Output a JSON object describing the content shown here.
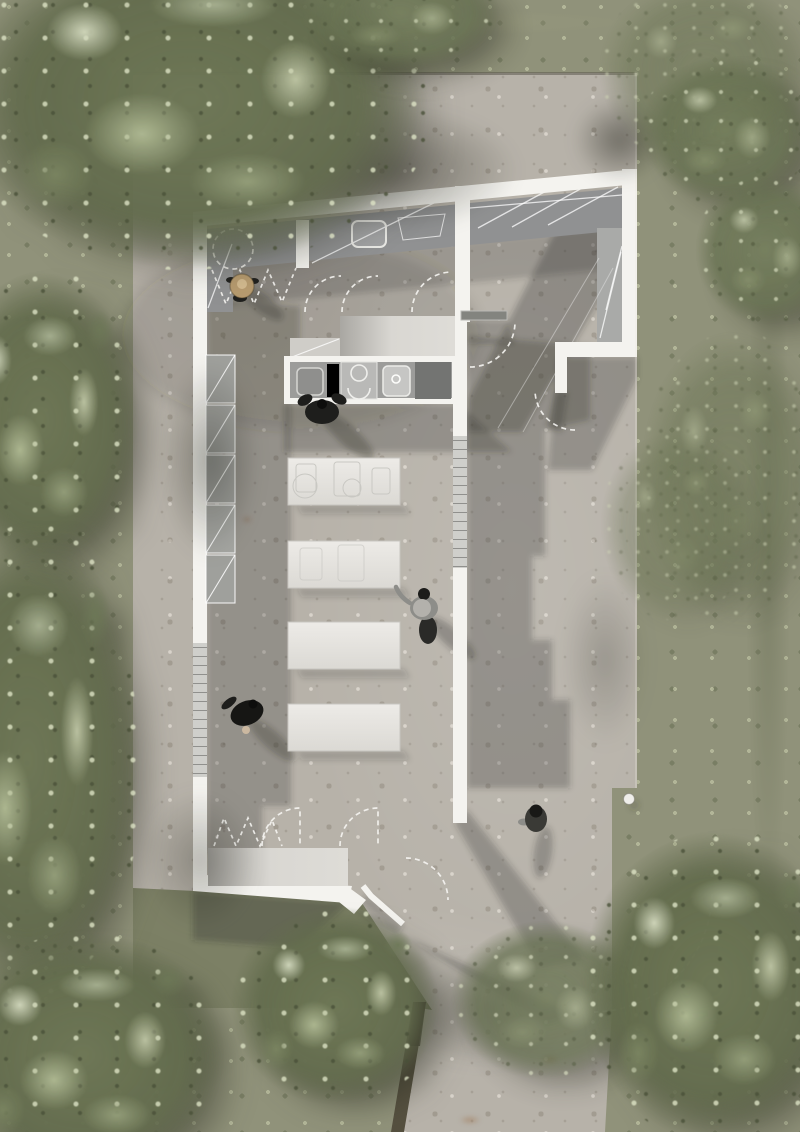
{
  "scene": {
    "type": "architectural-site-plan",
    "view": "top-down rendered plan",
    "subject": "L-shaped pavilion with outdoor kitchen, dining tables and surrounding trees",
    "people_count": 5,
    "dining_table_count": 4,
    "wall_panel_count": 5,
    "people": [
      {
        "id": "seated-person-straw-hat",
        "location": "upper-left terrace"
      },
      {
        "id": "person-at-kitchen-counter",
        "location": "below kitchen counter"
      },
      {
        "id": "walking-person-gray-shirt-hat",
        "location": "center courtyard"
      },
      {
        "id": "person-dark-clothes",
        "location": "lower-left courtyard"
      },
      {
        "id": "walking-person",
        "location": "lower-right terrace"
      }
    ],
    "features": [
      "sloped top wall with canopy band and skylight",
      "dashed door-swing arcs",
      "folding-door zigzag markings",
      "glazed wall sections",
      "kitchen counter with sinks and cooktop",
      "bench",
      "column dot",
      "path with timber kerb"
    ]
  },
  "colors": {
    "grassBase": "#90927a",
    "grassDark": "#7c8065",
    "concrete": "#b7b2a9",
    "wall": "#f4f3ef",
    "canopy": "#909192",
    "canopyLight": "#a9aaa8",
    "deckLight": "#d9d7d2",
    "glazing": "#cfcfcb",
    "glazingLine": "#90908d",
    "tableTop": "#e6e4e0",
    "counterTop": "#9c9c9a",
    "applianceDark": "#737472",
    "applianceMid": "#b9b9b7",
    "shadow": "#32322c",
    "personBlack": "#1e1e1c",
    "personGray": "#8d8d89",
    "hatTan": "#b79b6f",
    "hatGray": "#b3b1ac",
    "kerb": "#55503f",
    "marking": "#f6f5f2"
  }
}
